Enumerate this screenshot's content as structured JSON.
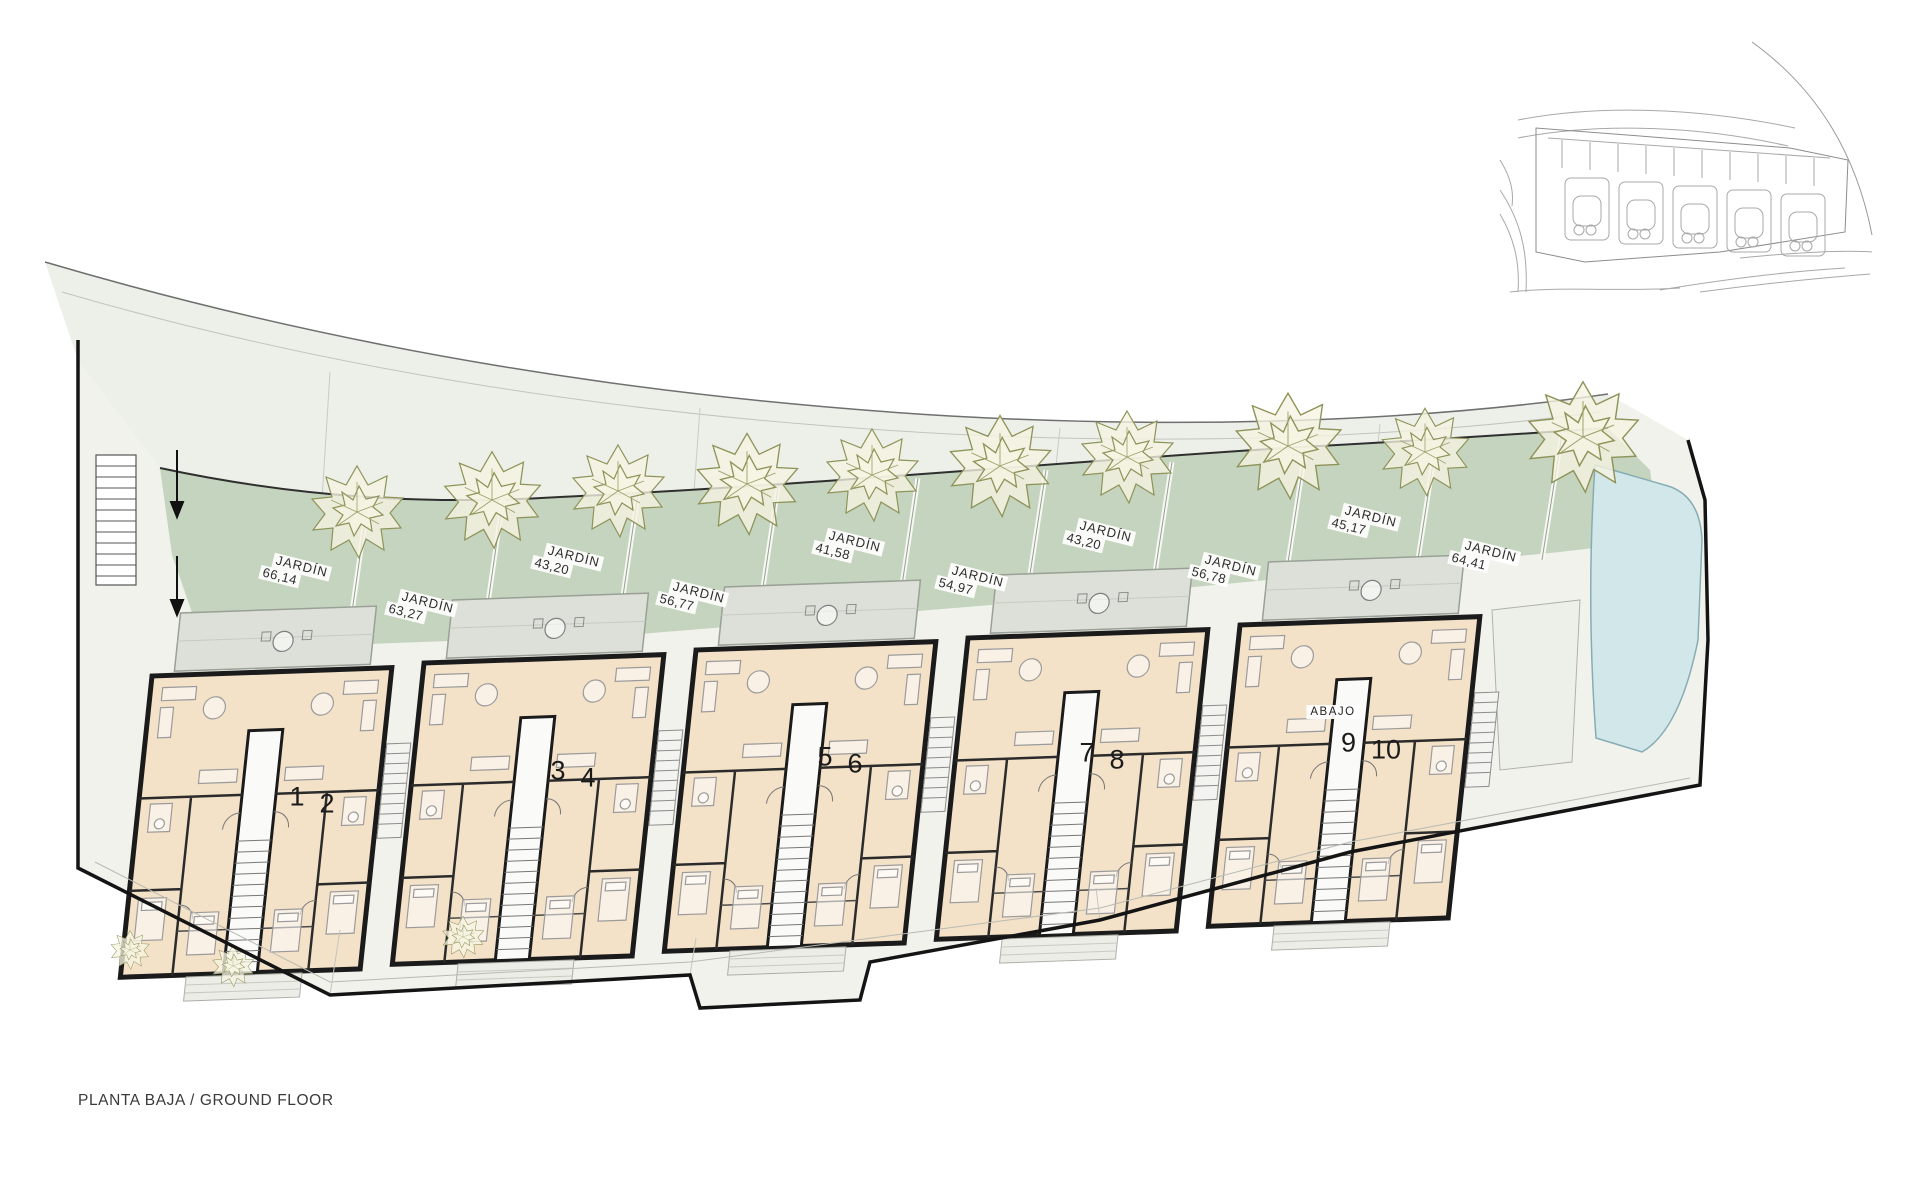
{
  "plan": {
    "floor_label": "PLANTA BAJA / GROUND FLOOR",
    "abajo_label": "ABAJO"
  },
  "gardens": [
    {
      "label": "JARDÍN",
      "area": "66,14"
    },
    {
      "label": "JARDÍN",
      "area": "63,27"
    },
    {
      "label": "JARDÍN",
      "area": "43,20"
    },
    {
      "label": "JARDÍN",
      "area": "56,77"
    },
    {
      "label": "JARDÍN",
      "area": "41,58"
    },
    {
      "label": "JARDÍN",
      "area": "54,97"
    },
    {
      "label": "JARDÍN",
      "area": "43,20"
    },
    {
      "label": "JARDÍN",
      "area": "56,78"
    },
    {
      "label": "JARDÍN",
      "area": "45,17"
    },
    {
      "label": "JARDÍN",
      "area": "64,41"
    }
  ],
  "units": [
    {
      "number": "1"
    },
    {
      "number": "2"
    },
    {
      "number": "3"
    },
    {
      "number": "4"
    },
    {
      "number": "5"
    },
    {
      "number": "6"
    },
    {
      "number": "7"
    },
    {
      "number": "8"
    },
    {
      "number": "9"
    },
    {
      "number": "10"
    }
  ],
  "colors": {
    "garden": "#c5d4be",
    "terrace": "#dde0d8",
    "floor": "#f3e1c8",
    "wall": "#1b1b1b",
    "pool": "#d2e7ea",
    "road": "#edefe9",
    "site": "#f1f2ec"
  }
}
